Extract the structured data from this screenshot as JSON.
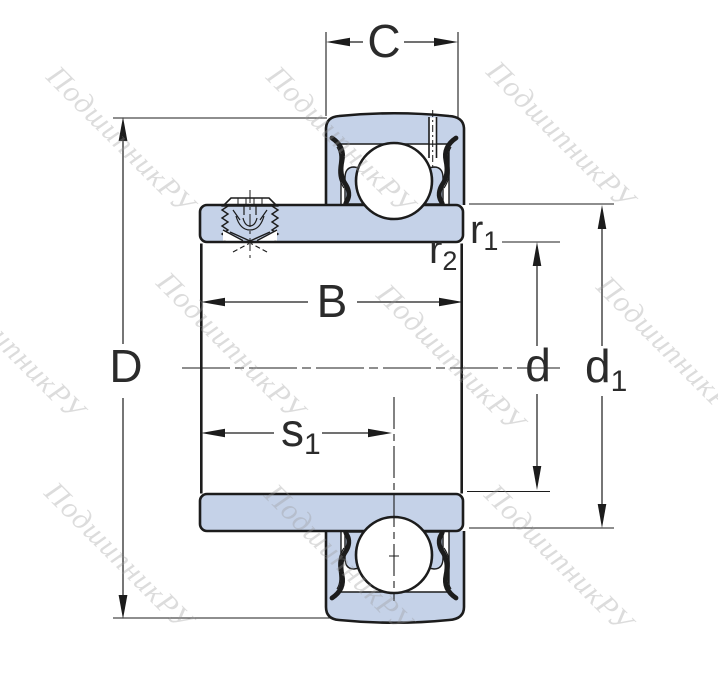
{
  "page": {
    "width": 718,
    "height": 682
  },
  "colors": {
    "part_fill": "#c5d2e8",
    "outline": "#1c1c1c",
    "label": "#2b2b2b",
    "watermark": "#999999",
    "background": "#ffffff"
  },
  "watermark": {
    "text": "ПодшипникРУ"
  },
  "dims": {
    "C": "C",
    "D": "D",
    "B": "B",
    "d": "d",
    "d1_base": "d",
    "d1_sub": "1",
    "s1_base": "s",
    "s1_sub": "1",
    "r1_base": "r",
    "r1_sub": "1",
    "r2_base": "r",
    "r2_sub": "2"
  }
}
